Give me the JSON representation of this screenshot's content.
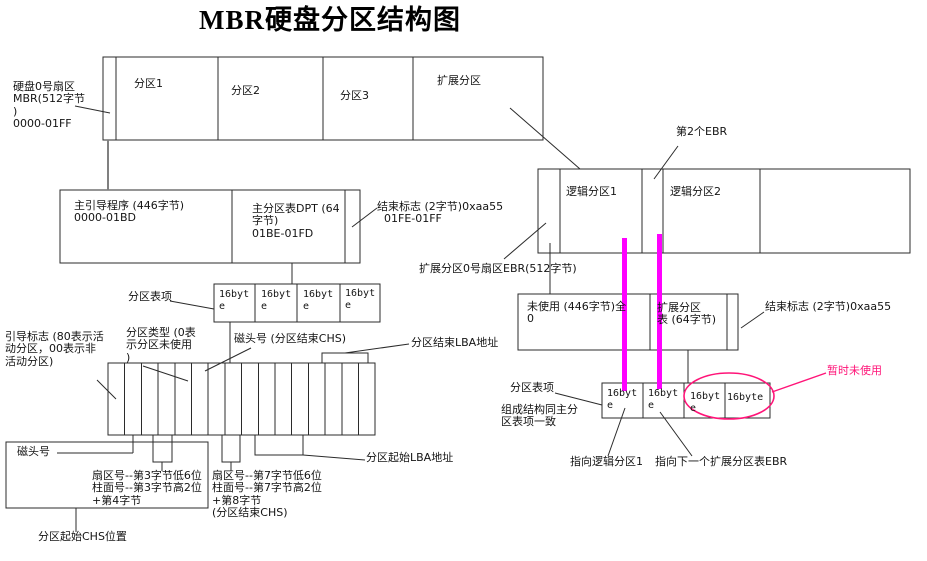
{
  "title": "MBR硬盘分区结构图",
  "colors": {
    "magenta": "#ff00ff",
    "pink": "#ff1478",
    "line": "#2b2b2b",
    "gray": "#808080"
  },
  "disk": {
    "sector0_label": "硬盘0号扇区\nMBR(512字节\n)\n0000-01FF",
    "partition1": "分区1",
    "partition2": "分区2",
    "partition3": "分区3",
    "extended": "扩展分区"
  },
  "mbr_detail": {
    "boot_program": "主引导程序 (446字节)\n0000-01BD",
    "dpt": "主分区表DPT (64\n字节)\n01BE-01FD",
    "end_flag": "结束标志 (2字节)0xaa55\n  01FE-01FF",
    "entry_label": "分区表项",
    "entry_cells": [
      "16byt\ne",
      "16byt\ne",
      "16byt\ne",
      "16byt\ne"
    ]
  },
  "entry_detail": {
    "boot_flag": "引导标志 (80表示活\n动分区，00表示非\n活动分区)",
    "part_type": "分区类型 (0表\n示分区未使用\n)",
    "head_end": "磁头号 (分区结束CHS)",
    "end_lba": "分区结束LBA地址",
    "head_start": "磁头号",
    "start_chs_bytes": "扇区号--第3字节低6位\n柱面号--第3字节高2位\n+第4字节",
    "end_chs_bytes": "扇区号--第7字节低6位\n柱面号--第7字节高2位\n+第8字节\n(分区结束CHS)",
    "start_lba": "分区起始LBA地址",
    "start_chs": "分区起始CHS位置"
  },
  "extended_detail": {
    "ebr2_label": "第2个EBR",
    "logical1": "逻辑分区1",
    "logical2": "逻辑分区2",
    "ebr_sector": "扩展分区0号扇区EBR(512字节)",
    "unused": "未使用 (446字节)全\n0",
    "ebr_table": "扩展分区\n表 (64字节)",
    "end_flag": "结束标志 (2字节)0xaa55",
    "entry_label": "分区表项",
    "entry_note": "组成结构同主分\n区表项一致",
    "cells": [
      "16byt\ne",
      "16byt\ne",
      "16byt\ne",
      "16byte"
    ],
    "temp_unused": "暂时未使用",
    "points_logical1": "指向逻辑分区1",
    "points_next": "指向下一个扩展分区表EBR"
  }
}
